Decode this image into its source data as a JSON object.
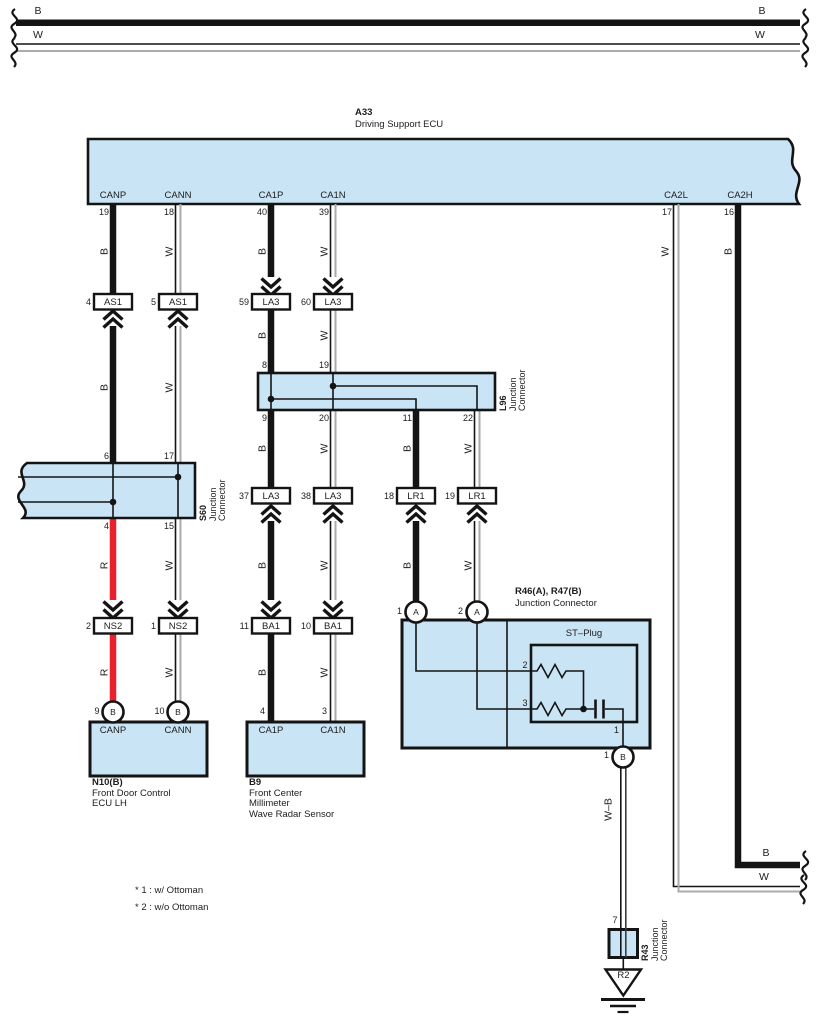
{
  "colors": {
    "box_fill": "#c9e4f4",
    "line": "#141414",
    "red_wire": "#e8212e",
    "gray_wire": "#ababab"
  },
  "top_bus": {
    "b_left": "B",
    "w_left": "W",
    "b_right": "B",
    "w_right": "W"
  },
  "a33": {
    "code": "A33",
    "desc": "Driving Support ECU",
    "pins": [
      {
        "num": "19",
        "label": "CANP"
      },
      {
        "num": "18",
        "label": "CANN"
      },
      {
        "num": "40",
        "label": "CA1P"
      },
      {
        "num": "39",
        "label": "CA1N"
      },
      {
        "num": "17",
        "label": "CA2L"
      },
      {
        "num": "16",
        "label": "CA2H"
      }
    ]
  },
  "seg": {
    "canp_1": "B",
    "cann_1": "W",
    "ca1p_1": "B",
    "ca1n_1": "W",
    "ca2l_1": "W",
    "ca2h_1": "B",
    "canp_2": "B",
    "cann_2": "W",
    "ca1p_2": "B",
    "ca1n_2": "W",
    "ca1p_3": "B",
    "ca1n_3": "W",
    "lr1_b_3": "B",
    "lr1_w_3": "W",
    "canp_3": "R",
    "cann_3": "W",
    "ca1p_4": "B",
    "ca1n_4": "W",
    "lr1_b_4": "B",
    "lr1_w_4": "W",
    "canp_4": "R",
    "cann_4": "W",
    "ca1p_5": "B",
    "ca1n_5": "W",
    "ca2h_exit": "B",
    "ca2l_exit": "W",
    "wb": "W–B"
  },
  "connectors": [
    {
      "num": "4",
      "label": "AS1"
    },
    {
      "num": "5",
      "label": "AS1"
    },
    {
      "num": "59",
      "label": "LA3"
    },
    {
      "num": "60",
      "label": "LA3"
    },
    {
      "num": "37",
      "label": "LA3"
    },
    {
      "num": "38",
      "label": "LA3"
    },
    {
      "num": "18",
      "label": "LR1"
    },
    {
      "num": "19",
      "label": "LR1"
    },
    {
      "num": "2",
      "label": "NS2"
    },
    {
      "num": "1",
      "label": "NS2"
    },
    {
      "num": "11",
      "label": "BA1"
    },
    {
      "num": "10",
      "label": "BA1"
    }
  ],
  "l96": {
    "code": "L96",
    "desc1": "Junction",
    "desc2": "Connector",
    "pin_top_1": "8",
    "pin_top_2": "19",
    "pin_bot_1": "9",
    "pin_bot_2": "20",
    "pin_bot_3": "11",
    "pin_bot_4": "22"
  },
  "s60": {
    "code": "S60",
    "desc1": "Junction",
    "desc2": "Connector",
    "pin_top_1": "6",
    "pin_top_2": "17",
    "pin_bot_1": "4",
    "pin_bot_2": "15"
  },
  "n10": {
    "code": "N10(B)",
    "desc1": "Front Door Control",
    "desc2": "ECU LH",
    "pin1_num": "9",
    "pin1_circ": "B",
    "pin2_num": "10",
    "pin2_circ": "B",
    "pin1_label": "CANP",
    "pin2_label": "CANN"
  },
  "b9": {
    "code": "B9",
    "desc1": "Front Center",
    "desc2": "Millimeter",
    "desc3": "Wave Radar Sensor",
    "pin1_num": "4",
    "pin2_num": "3",
    "pin1_label": "CA1P",
    "pin2_label": "CA1N"
  },
  "r46": {
    "title": "R46(A), R47(B)",
    "desc": "Junction Connector",
    "in1_num": "1",
    "in1_circ": "A",
    "in2_num": "2",
    "in2_circ": "A",
    "st_plug": "ST–Plug",
    "pin2": "2",
    "pin3": "3",
    "pin1": "1",
    "out_num": "1",
    "out_circ": "B"
  },
  "r43": {
    "code": "R43",
    "desc1": "Junction",
    "desc2": "Connector",
    "pin": "7"
  },
  "ground": {
    "label": "R2"
  },
  "notes": {
    "n1": "* 1 : w/ Ottoman",
    "n2": "* 2 : w/o Ottoman"
  }
}
